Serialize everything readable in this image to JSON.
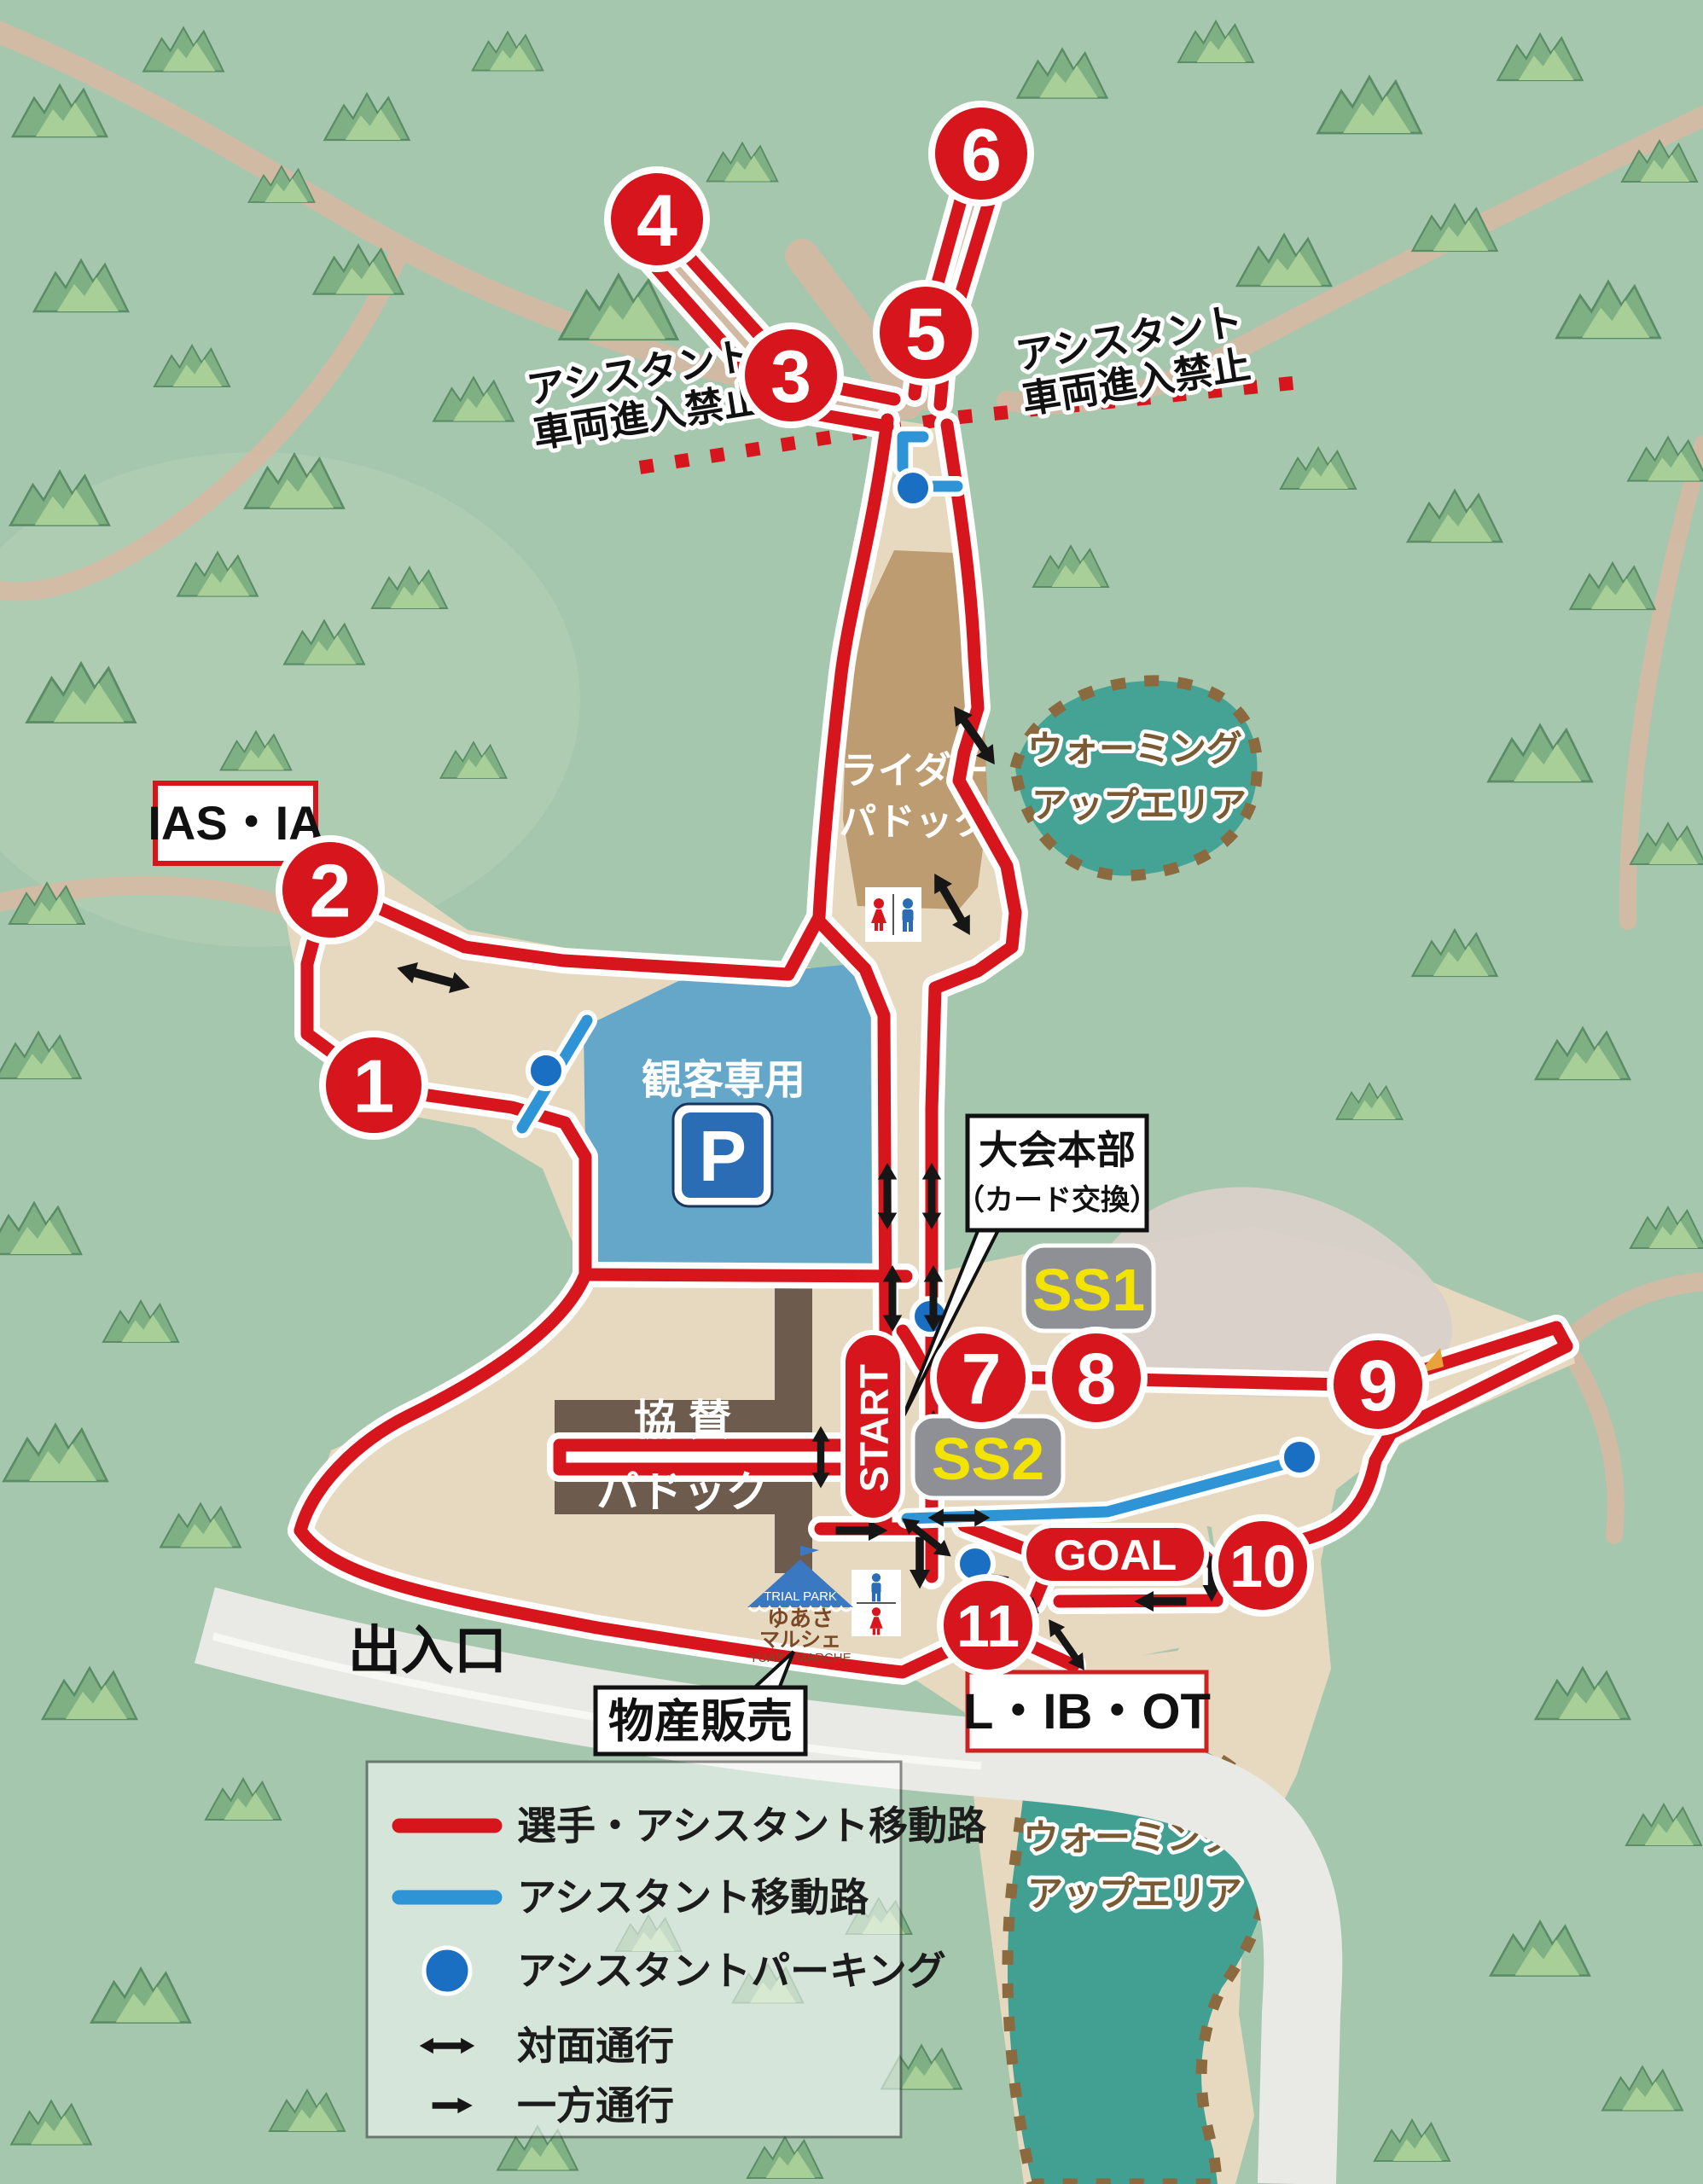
{
  "map": {
    "checkpoints": [
      {
        "n": "1"
      },
      {
        "n": "2"
      },
      {
        "n": "3"
      },
      {
        "n": "4"
      },
      {
        "n": "5"
      },
      {
        "n": "6"
      },
      {
        "n": "7"
      },
      {
        "n": "8"
      },
      {
        "n": "9"
      },
      {
        "n": "10"
      },
      {
        "n": "11"
      }
    ],
    "start_label": "START",
    "goal_label": "GOAL",
    "ss1_label": "SS1",
    "ss2_label": "SS2",
    "ias_ia_label": "IAS・IA",
    "l_ib_ot_label": "L・IB・OT",
    "hq": {
      "title": "大会本部",
      "subtitle": "（カード交換）"
    },
    "rider_paddock": {
      "line1": "ライダー",
      "line2": "パドック"
    },
    "sponsor_paddock": {
      "line1": "協 賛",
      "line2": "パドック"
    },
    "spectator_parking": {
      "label": "観客専用",
      "p": "P"
    },
    "warmup_top": {
      "line1": "ウォーミング",
      "line2": "アップエリア"
    },
    "warmup_bottom": {
      "line1": "ウォーミング",
      "line2": "アップエリア"
    },
    "assistant_ban_left": {
      "line1": "アシスタント",
      "line2": "車両進入禁止"
    },
    "assistant_ban_right": {
      "line1": "アシスタント",
      "line2": "車両進入禁止"
    },
    "entrance_label": "出入口",
    "products_label": "物産販売",
    "marche": {
      "park": "TRIAL PARK",
      "jp1": "ゆあさ",
      "jp2": "マルシェ",
      "en": "YUASA MARCHE"
    }
  },
  "legend": {
    "items": [
      {
        "type": "red-line",
        "label": "選手・アシスタント移動路"
      },
      {
        "type": "blue-line",
        "label": "アシスタント移動路"
      },
      {
        "type": "blue-dot",
        "label": "アシスタントパーキング"
      },
      {
        "type": "two-way-arrow",
        "label": "対面通行"
      },
      {
        "type": "one-way-arrow",
        "label": "一方通行"
      }
    ]
  },
  "colors": {
    "route_red": "#d6151d",
    "assistant_blue": "#2f94d6",
    "parking_dot_blue": "#1b6fc2",
    "spectator_parking_blue": "#64a7c9",
    "warmup_teal": "#45a396",
    "ground_tan": "#e7d9bf",
    "background_green": "#a5c7ad",
    "building_brown": "#6d5b4e",
    "paddock_brown": "#bd9c72",
    "ss_box_grey": "#8e9096",
    "ss_text_yellow": "#f2e300"
  }
}
